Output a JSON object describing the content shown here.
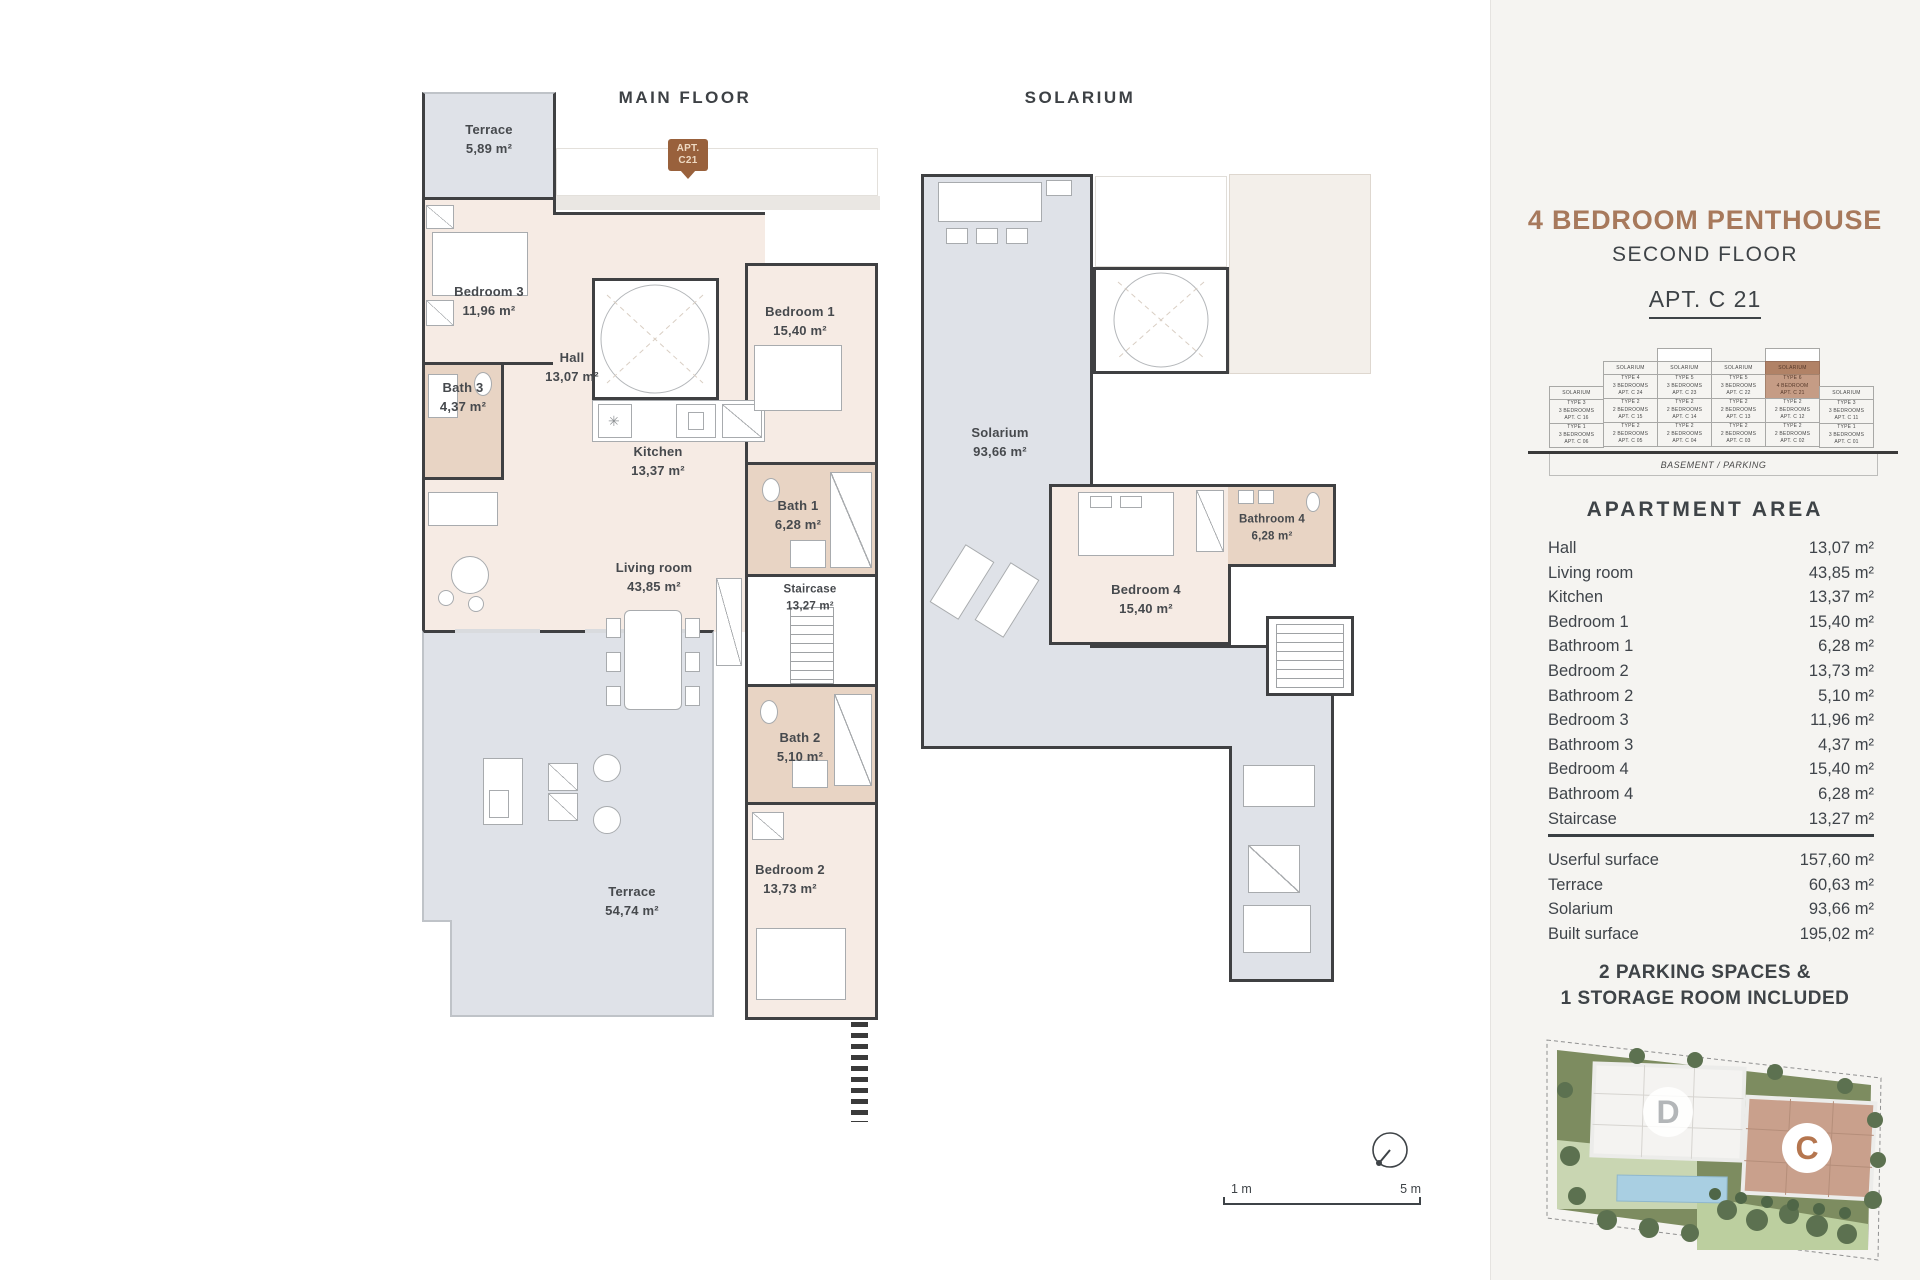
{
  "plans": {
    "main_floor": {
      "title": "MAIN FLOOR",
      "rooms": [
        {
          "name": "Terrace",
          "area": "5,89 m²"
        },
        {
          "name": "Bedroom 3",
          "area": "11,96 m²"
        },
        {
          "name": "Bath 3",
          "area": "4,37 m²"
        },
        {
          "name": "Hall",
          "area": "13,07 m²"
        },
        {
          "name": "Kitchen",
          "area": "13,37 m²"
        },
        {
          "name": "Bedroom 1",
          "area": "15,40 m²"
        },
        {
          "name": "Bath 1",
          "area": "6,28 m²"
        },
        {
          "name": "Living room",
          "area": "43,85 m²"
        },
        {
          "name": "Staircase",
          "area": "13,27 m²"
        },
        {
          "name": "Bath 2",
          "area": "5,10 m²"
        },
        {
          "name": "Bedroom 2",
          "area": "13,73 m²"
        },
        {
          "name": "Terrace",
          "area": "54,74 m²"
        }
      ]
    },
    "solarium": {
      "title": "SOLARIUM",
      "rooms": [
        {
          "name": "Solarium",
          "area": "93,66 m²"
        },
        {
          "name": "Bedroom 4",
          "area": "15,40 m²"
        },
        {
          "name": "Bathroom 4",
          "area": "6,28 m²"
        }
      ]
    },
    "apt_pin": {
      "line1": "APT.",
      "line2": "C21"
    },
    "scale": {
      "left": "1 m",
      "right": "5 m"
    }
  },
  "sidebar": {
    "title": "4 BEDROOM PENTHOUSE",
    "subtitle": "SECOND FLOOR",
    "apt": "APT. C 21",
    "accent_color": "#a7795c",
    "highlight_color": "#c59c85",
    "stack": {
      "basement": "BASEMENT / PARKING",
      "cols": [
        {
          "tag": "SOLARIUM",
          "units": [
            {
              "type": "TYPE 3",
              "beds": "3 BEDROOMS",
              "apt": "APT. C 16"
            },
            {
              "type": "TYPE 1",
              "beds": "3 BEDROOMS",
              "apt": "APT. C 06"
            }
          ]
        },
        {
          "tag": "SOLARIUM",
          "units": [
            {
              "type": "TYPE 4",
              "beds": "3 BEDROOMS",
              "apt": "APT. C 24"
            },
            {
              "type": "TYPE 2",
              "beds": "2 BEDROOMS",
              "apt": "APT. C 15"
            },
            {
              "type": "TYPE 2",
              "beds": "2 BEDROOMS",
              "apt": "APT. C 05"
            }
          ]
        },
        {
          "tag": "SOLARIUM",
          "units": [
            {
              "type": "TYPE 5",
              "beds": "3 BEDROOMS",
              "apt": "APT. C 23"
            },
            {
              "type": "TYPE 2",
              "beds": "2 BEDROOMS",
              "apt": "APT. C 14"
            },
            {
              "type": "TYPE 2",
              "beds": "2 BEDROOMS",
              "apt": "APT. C 04"
            }
          ]
        },
        {
          "tag": "SOLARIUM",
          "units": [
            {
              "type": "TYPE 5",
              "beds": "3 BEDROOMS",
              "apt": "APT. C 22"
            },
            {
              "type": "TYPE 2",
              "beds": "2 BEDROOMS",
              "apt": "APT. C 13"
            },
            {
              "type": "TYPE 2",
              "beds": "2 BEDROOMS",
              "apt": "APT. C 03"
            }
          ]
        },
        {
          "tag": "SOLARIUM",
          "units": [
            {
              "type": "TYPE 6",
              "beds": "4 BEDROOM",
              "apt": "APT. C 21"
            },
            {
              "type": "TYPE 2",
              "beds": "2 BEDROOMS",
              "apt": "APT. C 12"
            },
            {
              "type": "TYPE 2",
              "beds": "2 BEDROOMS",
              "apt": "APT. C 02"
            }
          ]
        },
        {
          "tag": "SOLARIUM",
          "units": [
            {
              "type": "TYPE 3",
              "beds": "3 BEDROOMS",
              "apt": "APT. C 11"
            },
            {
              "type": "TYPE 1",
              "beds": "3 BEDROOMS",
              "apt": "APT. C 01"
            }
          ]
        }
      ]
    },
    "area_heading": "APARTMENT AREA",
    "area_rows": [
      {
        "label": "Hall",
        "value": "13,07 m²"
      },
      {
        "label": "Living room",
        "value": "43,85 m²"
      },
      {
        "label": "Kitchen",
        "value": "13,37 m²"
      },
      {
        "label": "Bedroom 1",
        "value": "15,40 m²"
      },
      {
        "label": "Bathroom 1",
        "value": "6,28 m²"
      },
      {
        "label": "Bedroom 2",
        "value": "13,73 m²"
      },
      {
        "label": "Bathroom 2",
        "value": "5,10 m²"
      },
      {
        "label": "Bedroom 3",
        "value": "11,96 m²"
      },
      {
        "label": "Bathroom 3",
        "value": "4,37 m²"
      },
      {
        "label": "Bedroom 4",
        "value": "15,40 m²"
      },
      {
        "label": "Bathroom 4",
        "value": "6,28 m²"
      },
      {
        "label": "Staircase",
        "value": "13,27 m²"
      }
    ],
    "totals": [
      {
        "label": "Userful surface",
        "value": "157,60 m²"
      },
      {
        "label": "Terrace",
        "value": "60,63 m²"
      },
      {
        "label": "Solarium",
        "value": "93,66 m²"
      },
      {
        "label": "Built surface",
        "value": "195,02 m²"
      }
    ],
    "parking_line1": "2 PARKING SPACES &",
    "parking_line2": "1 STORAGE ROOM INCLUDED",
    "site_map": {
      "d_label": "D",
      "c_label": "C"
    }
  }
}
